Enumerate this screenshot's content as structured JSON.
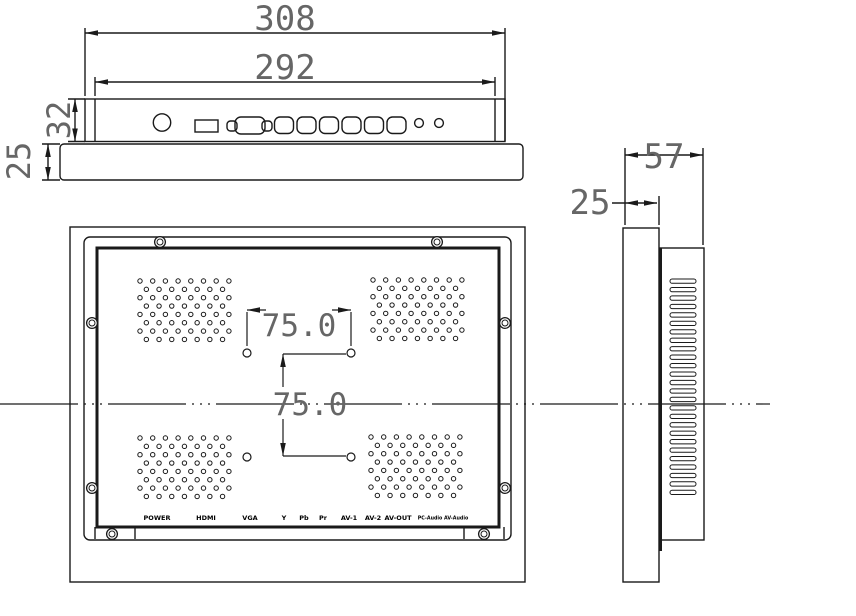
{
  "drawing": {
    "title": "open-frame-panel-monitor-dimension-drawing",
    "views": {
      "top_view": {
        "dim_outer_width": "308",
        "dim_inner_width": "292",
        "dim_body_height": "32",
        "dim_bezel_height": "25"
      },
      "rear_view": {
        "dim_vesa_horizontal": "75.0",
        "dim_vesa_vertical": "75.0",
        "port_labels": [
          "POWER",
          "HDMI",
          "VGA",
          "Y",
          "Pb",
          "Pr",
          "AV-1",
          "AV-2",
          "AV-OUT",
          "PC-Audio AV-Audio"
        ],
        "vent_grid": {
          "rows": 8,
          "cols": 8
        },
        "vesa_hole_count": 4,
        "screw_count": 8
      },
      "side_view": {
        "dim_total_depth": "57",
        "dim_bezel_depth": "25",
        "vent_slot_count": 26
      }
    },
    "colors": {
      "line": "#1a1a1a",
      "dim_text": "#666666",
      "background": "#ffffff"
    }
  }
}
